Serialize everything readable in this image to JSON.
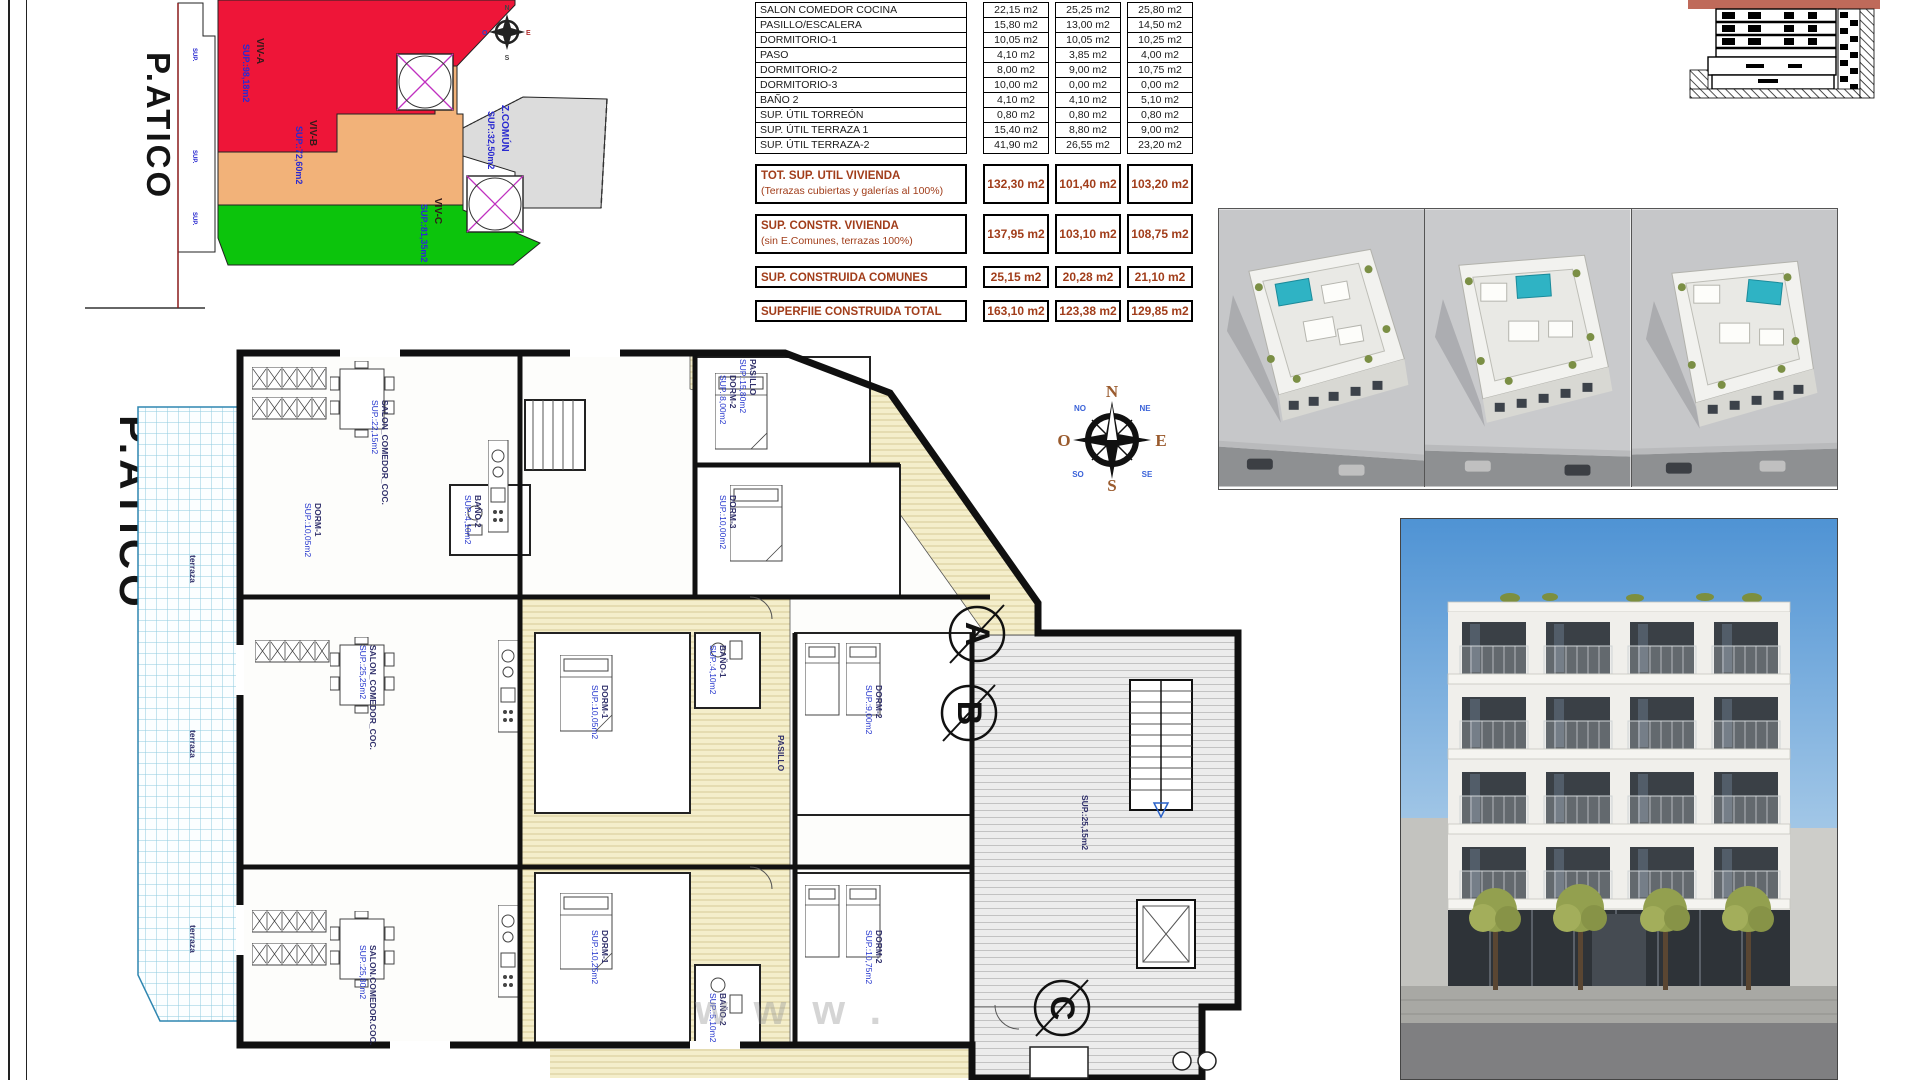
{
  "sheet": {
    "watermark": "www."
  },
  "site_plan": {
    "title": "P.ATICO",
    "zones": [
      {
        "name": "VIV-A",
        "sup": "SUP.:98,18m2",
        "color": "#ee1538"
      },
      {
        "name": "VIV-B",
        "sup": "SUP.:72,60m2",
        "color": "#f2b279"
      },
      {
        "name": "VIV-C",
        "sup": "SUP.:81,35m2",
        "color": "#0cc40c"
      },
      {
        "name": "Z.COMÚN",
        "sup": "SUP.:32,50m2",
        "color": "#dcdcdc"
      }
    ],
    "strip_labels": [
      "SUP.",
      "SUP.",
      "SUP."
    ],
    "mini_compass": {
      "n": "N",
      "e": "E",
      "s": "S",
      "o": "O"
    }
  },
  "area_table": {
    "rows": [
      {
        "label": "SALON COMEDOR COCINA",
        "values": [
          "22,15 m2",
          "25,25 m2",
          "25,80 m2"
        ]
      },
      {
        "label": "PASILLO/ESCALERA",
        "values": [
          "15,80 m2",
          "13,00 m2",
          "14,50 m2"
        ]
      },
      {
        "label": "DORMITORIO-1",
        "values": [
          "10,05 m2",
          "10,05 m2",
          "10,25 m2"
        ]
      },
      {
        "label": "PASO",
        "values": [
          "4,10 m2",
          "3,85 m2",
          "4,00 m2"
        ]
      },
      {
        "label": "DORMITORIO-2",
        "values": [
          "8,00 m2",
          "9,00 m2",
          "10,75 m2"
        ]
      },
      {
        "label": "DORMITORIO-3",
        "values": [
          "10,00 m2",
          "0,00 m2",
          "0,00 m2"
        ]
      },
      {
        "label": "BAÑO 2",
        "values": [
          "4,10 m2",
          "4,10 m2",
          "5,10 m2"
        ]
      },
      {
        "label": "SUP. ÚTIL TORREÓN",
        "values": [
          "0,80 m2",
          "0,80 m2",
          "0,80 m2"
        ]
      },
      {
        "label": "SUP. ÚTIL TERRAZA 1",
        "values": [
          "15,40 m2",
          "8,80 m2",
          "9,00 m2"
        ]
      },
      {
        "label": "SUP. ÚTIL TERRAZA-2",
        "values": [
          "41,90 m2",
          "26,55 m2",
          "23,20 m2"
        ]
      }
    ],
    "totals": [
      {
        "label": "TOT. SUP. UTIL VIVIENDA",
        "sublabel": "(Terrazas cubiertas y galerías al 100%)",
        "values": [
          "132,30 m2",
          "101,40 m2",
          "103,20 m2"
        ]
      },
      {
        "label": "SUP. CONSTR. VIVIENDA",
        "sublabel": "(sin E.Comunes, terrazas 100%)",
        "values": [
          "137,95 m2",
          "103,10 m2",
          "108,75 m2"
        ]
      },
      {
        "label": "SUP. CONSTRUIDA COMUNES",
        "sublabel": "",
        "values": [
          "25,15 m2",
          "20,28 m2",
          "21,10 m2"
        ]
      },
      {
        "label": "SUPERFIIE CONSTRUIDA TOTAL",
        "sublabel": "",
        "values": [
          "163,10 m2",
          "123,38 m2",
          "129,85 m2"
        ]
      }
    ]
  },
  "compass": {
    "n": "N",
    "s": "S",
    "e": "E",
    "o": "O",
    "ne": "NE",
    "no": "NO",
    "se": "SE",
    "so": "SO"
  },
  "floor_plan": {
    "title": "P.ATICO",
    "units": [
      "A",
      "B",
      "C"
    ],
    "labels": [
      {
        "n": "SALON_COMEDOR_COC.",
        "s": "SUP.:22,15m2",
        "x": 292,
        "y": 55
      },
      {
        "n": "DORM-1",
        "s": "SUP.:10,05m2",
        "x": 225,
        "y": 158
      },
      {
        "n": "DORM-2",
        "s": "SUP.:8,00m2",
        "x": 640,
        "y": 30
      },
      {
        "n": "DORM-3",
        "s": "SUP.:10,00m2",
        "x": 640,
        "y": 150
      },
      {
        "n": "BAÑO-2",
        "s": "SUP.:4,10m2",
        "x": 385,
        "y": 150
      },
      {
        "n": "PASILLO",
        "s": "SUP.:15,80m2",
        "x": 660,
        "y": 14
      },
      {
        "n": "SALON_COMEDOR_COC.",
        "s": "SUP.:25,25m2",
        "x": 280,
        "y": 300
      },
      {
        "n": "DORM-1",
        "s": "SUP.:10,05m2",
        "x": 512,
        "y": 340
      },
      {
        "n": "DORM-2",
        "s": "SUP.:9,00m2",
        "x": 786,
        "y": 340
      },
      {
        "n": "BAÑO-1",
        "s": "SUP.:4,10m2",
        "x": 630,
        "y": 300
      },
      {
        "n": "PASILLO",
        "s": "",
        "x": 688,
        "y": 390
      },
      {
        "n": "SALON.COMEDOR.COC.",
        "s": "SUP.:25,80m2",
        "x": 280,
        "y": 600
      },
      {
        "n": "DORM-1",
        "s": "SUP.:10,25m2",
        "x": 512,
        "y": 585
      },
      {
        "n": "DORM-2",
        "s": "SUP.:10,75m2",
        "x": 786,
        "y": 585
      },
      {
        "n": "BAÑO-2",
        "s": "SUP.:5,10m2",
        "x": 630,
        "y": 648
      },
      {
        "n": "SUP.:25,15m2",
        "s": "",
        "x": 992,
        "y": 450
      },
      {
        "n": "terraza",
        "s": "",
        "x": 100,
        "y": 210
      },
      {
        "n": "terraza",
        "s": "",
        "x": 100,
        "y": 385
      },
      {
        "n": "terraza",
        "s": "",
        "x": 100,
        "y": 580
      }
    ]
  }
}
